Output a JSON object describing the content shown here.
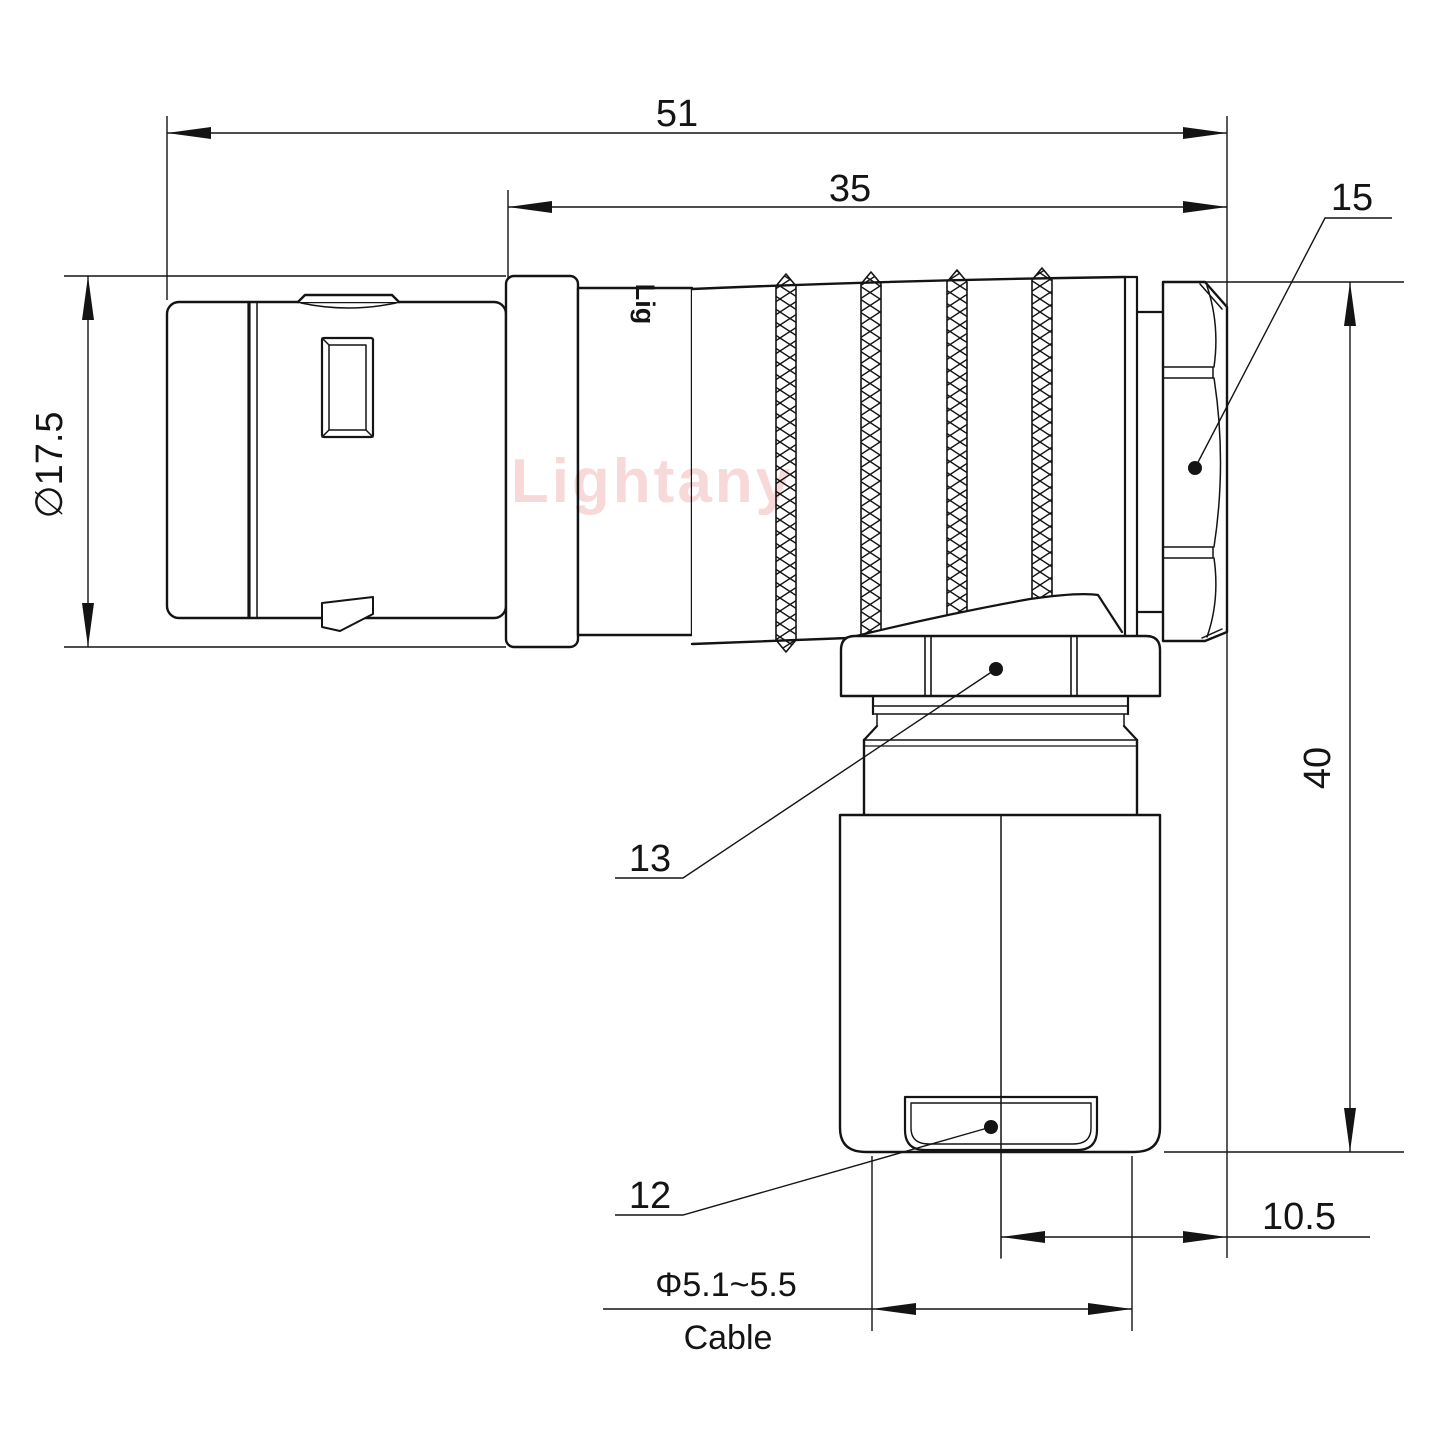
{
  "drawing": {
    "watermark": "Lightany",
    "part_marking": "Lig",
    "background": "#ffffff",
    "line_color": "#141414",
    "watermark_color": "#f0b4b4"
  },
  "dimensions": {
    "overall_length": {
      "label": "51"
    },
    "rear_length": {
      "label": "35"
    },
    "front_diameter": {
      "label": "∅17.5"
    },
    "height": {
      "label": "40"
    },
    "axis_offset": {
      "label": "10.5"
    },
    "cable_diameter": {
      "label": "Φ5.1~5.5"
    },
    "cable_word": {
      "label": "Cable"
    }
  },
  "callouts": {
    "back_shell_nut": {
      "label": "15"
    },
    "coupling_nut": {
      "label": "13"
    },
    "cable_bushing": {
      "label": "12"
    }
  }
}
